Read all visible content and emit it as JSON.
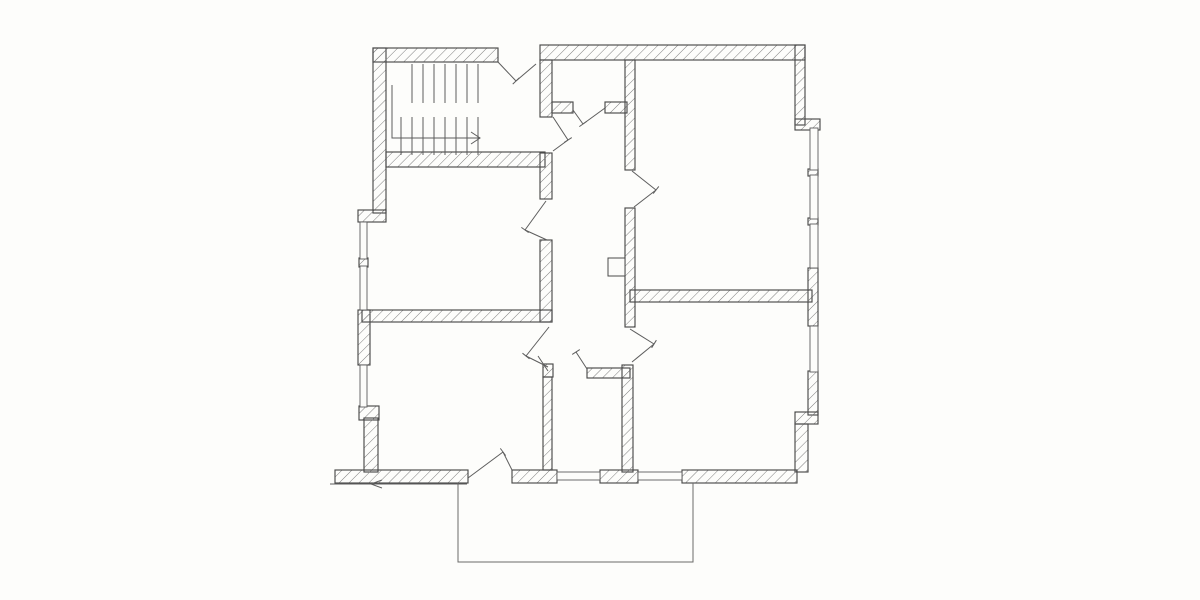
{
  "page": {
    "background": "#ffffff",
    "paper": "#fcfcfa"
  },
  "drawing": {
    "description": "hand-drawn apartment floor plan, pen on white paper, no text labels",
    "canvas": {
      "width": 1200,
      "height": 600
    },
    "colors": {
      "ink": "#4a4a4a",
      "hatch": "#7e7e7e",
      "thin": "#5d5d5d"
    },
    "walls": [
      {
        "x": 373,
        "y": 48,
        "w": 13,
        "h": 165
      },
      {
        "x": 358,
        "y": 210,
        "w": 28,
        "h": 12
      },
      {
        "x": 373,
        "y": 48,
        "w": 125,
        "h": 14
      },
      {
        "x": 540,
        "y": 45,
        "w": 265,
        "h": 15
      },
      {
        "x": 795,
        "y": 45,
        "w": 10,
        "h": 80
      },
      {
        "x": 795,
        "y": 119,
        "w": 25,
        "h": 11
      },
      {
        "x": 808,
        "y": 268,
        "w": 10,
        "h": 58
      },
      {
        "x": 808,
        "y": 371,
        "w": 10,
        "h": 44
      },
      {
        "x": 795,
        "y": 412,
        "w": 23,
        "h": 12
      },
      {
        "x": 795,
        "y": 424,
        "w": 13,
        "h": 48
      },
      {
        "x": 358,
        "y": 310,
        "w": 12,
        "h": 55
      },
      {
        "x": 359,
        "y": 406,
        "w": 20,
        "h": 14
      },
      {
        "x": 364,
        "y": 418,
        "w": 14,
        "h": 54
      },
      {
        "x": 335,
        "y": 470,
        "w": 133,
        "h": 13
      },
      {
        "x": 512,
        "y": 470,
        "w": 45,
        "h": 13
      },
      {
        "x": 600,
        "y": 470,
        "w": 38,
        "h": 13
      },
      {
        "x": 682,
        "y": 470,
        "w": 115,
        "h": 13
      },
      {
        "x": 359,
        "y": 258,
        "w": 9,
        "h": 9
      },
      {
        "x": 808,
        "y": 169,
        "w": 10,
        "h": 7
      },
      {
        "x": 808,
        "y": 218,
        "w": 10,
        "h": 7
      },
      {
        "x": 386,
        "y": 152,
        "w": 159,
        "h": 15
      },
      {
        "x": 540,
        "y": 60,
        "w": 12,
        "h": 57
      },
      {
        "x": 552,
        "y": 102,
        "w": 21,
        "h": 11
      },
      {
        "x": 605,
        "y": 102,
        "w": 22,
        "h": 11
      },
      {
        "x": 540,
        "y": 153,
        "w": 12,
        "h": 46
      },
      {
        "x": 540,
        "y": 240,
        "w": 12,
        "h": 82
      },
      {
        "x": 362,
        "y": 310,
        "w": 190,
        "h": 12
      },
      {
        "x": 543,
        "y": 364,
        "w": 10,
        "h": 13
      },
      {
        "x": 543,
        "y": 377,
        "w": 9,
        "h": 93
      },
      {
        "x": 625,
        "y": 60,
        "w": 10,
        "h": 110
      },
      {
        "x": 625,
        "y": 208,
        "w": 10,
        "h": 119
      },
      {
        "x": 630,
        "y": 290,
        "w": 182,
        "h": 12
      },
      {
        "x": 622,
        "y": 365,
        "w": 11,
        "h": 107
      },
      {
        "x": 587,
        "y": 368,
        "w": 43,
        "h": 10
      }
    ],
    "windows": [
      {
        "x": 360,
        "y": 222,
        "w": 7,
        "h": 37
      },
      {
        "x": 360,
        "y": 266,
        "w": 7,
        "h": 44
      },
      {
        "x": 360,
        "y": 365,
        "w": 7,
        "h": 42
      },
      {
        "x": 557,
        "y": 472,
        "w": 43,
        "h": 8
      },
      {
        "x": 638,
        "y": 472,
        "w": 44,
        "h": 8
      },
      {
        "x": 810,
        "y": 128,
        "w": 8,
        "h": 42
      },
      {
        "x": 810,
        "y": 175,
        "w": 8,
        "h": 44
      },
      {
        "x": 810,
        "y": 224,
        "w": 8,
        "h": 44
      },
      {
        "x": 810,
        "y": 326,
        "w": 8,
        "h": 46
      }
    ],
    "doors": [
      {
        "lines": [
          [
            498,
            62,
            516,
            81
          ],
          [
            516,
            81,
            536,
            64
          ]
        ],
        "tick": [
          516,
          81
        ]
      },
      {
        "lines": [
          [
            573,
            110,
            583,
            124
          ],
          [
            583,
            124,
            605,
            108
          ]
        ],
        "tick": [
          583,
          124
        ]
      },
      {
        "lines": [
          [
            553,
            117,
            568,
            140
          ],
          [
            568,
            140,
            553,
            151
          ]
        ],
        "tick": [
          568,
          140
        ]
      },
      {
        "lines": [
          [
            546,
            201,
            525,
            230
          ],
          [
            525,
            230,
            547,
            240
          ]
        ],
        "tick": [
          525,
          230
        ]
      },
      {
        "lines": [
          [
            632,
            171,
            656,
            190
          ],
          [
            656,
            190,
            634,
            207
          ]
        ],
        "tick": [
          656,
          190
        ]
      },
      {
        "lines": [
          [
            549,
            327,
            526,
            356
          ],
          [
            526,
            356,
            548,
            367
          ]
        ],
        "tick": [
          526,
          356
        ]
      },
      {
        "lines": [
          [
            587,
            369,
            576,
            352
          ],
          [
            548,
            371,
            538,
            356
          ]
        ],
        "tick": [
          576,
          352
        ]
      },
      {
        "lines": [
          [
            630,
            329,
            654,
            344
          ],
          [
            654,
            344,
            632,
            362
          ]
        ],
        "tick": [
          654,
          344
        ]
      },
      {
        "lines": [
          [
            468,
            478,
            503,
            452
          ],
          [
            503,
            452,
            512,
            470
          ]
        ],
        "tick": [
          503,
          452
        ]
      }
    ],
    "stairs": {
      "upper_treads": {
        "xs": [
          412,
          423,
          434,
          445,
          456,
          467,
          478
        ],
        "y1": 64,
        "y2": 103
      },
      "lower_treads": {
        "xs": [
          401,
          412,
          423,
          434,
          445,
          456,
          467,
          478
        ],
        "y1": 117,
        "y2": 155
      },
      "arrow_path": [
        [
          392,
          85
        ],
        [
          392,
          138
        ],
        [
          480,
          138
        ]
      ],
      "arrow_head": [
        480,
        138
      ]
    },
    "balcony": {
      "points": [
        [
          458,
          483
        ],
        [
          458,
          562
        ],
        [
          693,
          562
        ],
        [
          693,
          483
        ]
      ]
    },
    "shaft_box": {
      "x": 608,
      "y": 258,
      "w": 17,
      "h": 18
    },
    "ground_line": {
      "x1": 330,
      "y1": 484,
      "x2": 467,
      "y2": 484,
      "arrow_at": [
        372,
        484
      ]
    }
  }
}
